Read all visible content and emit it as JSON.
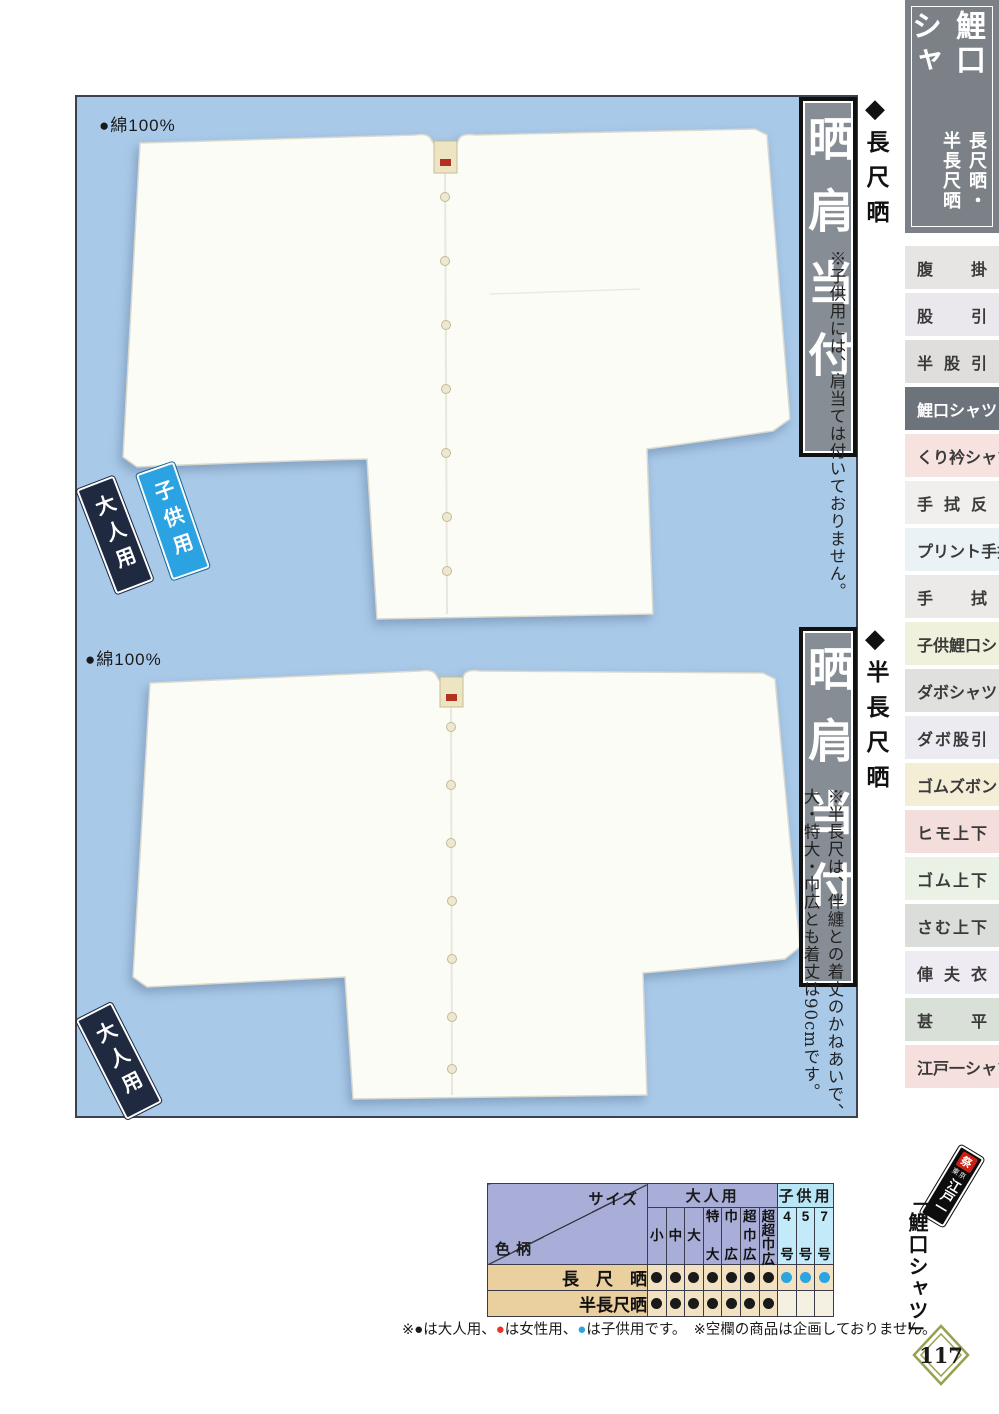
{
  "header": {
    "title": "鯉口シャツ",
    "subtitle": "長尺晒・半長尺晒"
  },
  "sidebar": {
    "items": [
      {
        "label": "腹掛",
        "bg": "#e7e5e3",
        "active": false
      },
      {
        "label": "股引",
        "bg": "#eae8ec",
        "active": false
      },
      {
        "label": "半股引",
        "bg": "#dfdedc",
        "active": false
      },
      {
        "label": "鯉口シャツ",
        "bg": "#6d737a",
        "active": true
      },
      {
        "label": "くり衿シャツ",
        "bg": "#f6e3df",
        "active": false
      },
      {
        "label": "手拭反",
        "bg": "#f0efed",
        "active": false
      },
      {
        "label": "プリント手拭",
        "bg": "#eaf2f6",
        "active": false
      },
      {
        "label": "手拭",
        "bg": "#eceae8",
        "active": false
      },
      {
        "label": "子供鯉口シャツ",
        "bg": "#f0f1dd",
        "active": false
      },
      {
        "label": "ダボシャツ",
        "bg": "#e0e0de",
        "active": false
      },
      {
        "label": "ダボ股引",
        "bg": "#ecebf1",
        "active": false
      },
      {
        "label": "ゴムズボン",
        "bg": "#f4eed6",
        "active": false
      },
      {
        "label": "ヒモ上下",
        "bg": "#f4dedc",
        "active": false
      },
      {
        "label": "ゴム上下",
        "bg": "#eaf2e6",
        "active": false
      },
      {
        "label": "さむ上下",
        "bg": "#dbdddb",
        "active": false
      },
      {
        "label": "俥夫衣",
        "bg": "#eeecf2",
        "active": false
      },
      {
        "label": "甚平",
        "bg": "#d8e0d8",
        "active": false
      },
      {
        "label": "江戸一シャツ",
        "bg": "#f6e0de",
        "active": false
      }
    ]
  },
  "icons": {
    "diamond": "◆",
    "dot": "●"
  },
  "products": [
    {
      "material": "●綿100%",
      "section_title": "長尺晒",
      "badge": "晒肩当付",
      "note": "※子供用には、肩当ては付いておりません。",
      "tags": [
        "大人用",
        "子供用"
      ]
    },
    {
      "material": "●綿100%",
      "section_title": "半長尺晒",
      "badge": "晒肩当付",
      "note": "※半長尺は、伴纏との着丈のかねあいで、大・特大・巾広とも着丈は90cmです。",
      "tags": [
        "大人用"
      ]
    }
  ],
  "size_table": {
    "corner": {
      "top_right": "サイズ",
      "bottom_left": "色柄"
    },
    "groups": [
      {
        "label": "大人用",
        "span": 7,
        "type": "adult"
      },
      {
        "label": "子供用",
        "span": 3,
        "type": "child"
      }
    ],
    "columns": [
      {
        "label": "小",
        "type": "adult"
      },
      {
        "label": "中",
        "type": "adult"
      },
      {
        "label": "大",
        "type": "adult"
      },
      {
        "label": "特大",
        "type": "adult"
      },
      {
        "label": "巾広",
        "type": "adult"
      },
      {
        "label": "超巾広",
        "type": "adult"
      },
      {
        "label": "超超巾広",
        "type": "adult"
      },
      {
        "label": "4号",
        "type": "child"
      },
      {
        "label": "5号",
        "type": "child"
      },
      {
        "label": "7号",
        "type": "child"
      }
    ],
    "rows": [
      {
        "label": "長　尺　晒",
        "cells": [
          "adult",
          "adult",
          "adult",
          "adult",
          "adult",
          "adult",
          "adult",
          "child",
          "child",
          "child"
        ]
      },
      {
        "label": "半長尺晒",
        "cells": [
          "adult",
          "adult",
          "adult",
          "adult",
          "adult",
          "adult",
          "adult",
          "",
          "",
          ""
        ]
      }
    ]
  },
  "legend": {
    "prefix": "※",
    "marks": [
      {
        "symbol": "●",
        "color": "#1a1a1a",
        "label": "は大人用、"
      },
      {
        "symbol": "●",
        "color": "#e8332a",
        "label": "は女性用、"
      },
      {
        "symbol": "●",
        "color": "#2aa5e2",
        "label": "は子供用です。"
      }
    ],
    "note2": "※空欄の商品は企画しておりません。"
  },
  "footer": {
    "category": "「鯉口シャツ」",
    "page_number": "117",
    "brand": {
      "stamp": "祭",
      "top": "東京",
      "name": "江戸一"
    }
  },
  "colors": {
    "panel_blue": "#a9c9e9",
    "header_gray": "#7c8187",
    "active_item_bg": "#6d737a",
    "badge_inner_gray": "#878d94",
    "table_header_purple": "#a9aed8",
    "table_header_child_blue": "#b9e6f7",
    "table_child_cell_blue": "#c3eaf9",
    "row_label_tan": "#eacf9f",
    "row_cell_tan": "#f2e2c2",
    "empty_cell_cream": "#f4f1e3",
    "dot_adult": "#1a1a1a",
    "dot_women": "#e8332a",
    "dot_child": "#2aa5e2",
    "tag_adult_navy": "#1f2940",
    "tag_child_blue": "#2ba3e3",
    "diamond_olive": "#99a04f"
  }
}
